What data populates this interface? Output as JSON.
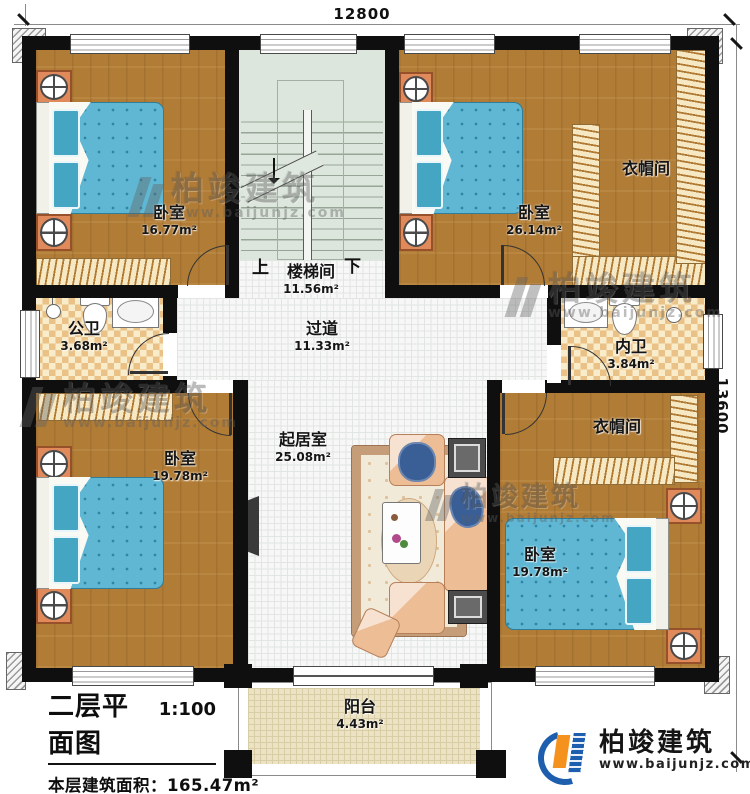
{
  "dimensions": {
    "top": "12800",
    "right": "13600"
  },
  "rooms": {
    "bedroom_tl": {
      "name": "卧室",
      "area": "16.77m²"
    },
    "bedroom_tr": {
      "name": "卧室",
      "area": "26.14m²"
    },
    "cloak_tr": {
      "name": "衣帽间"
    },
    "stair": {
      "name": "楼梯间",
      "area": "11.56m²",
      "up": "上",
      "down": "下"
    },
    "public_bath": {
      "name": "公卫",
      "area": "3.68m²"
    },
    "private_bath": {
      "name": "内卫",
      "area": "3.84m²"
    },
    "hall": {
      "name": "过道",
      "area": "11.33m²"
    },
    "living": {
      "name": "起居室",
      "area": "25.08m²"
    },
    "bedroom_bl": {
      "name": "卧室",
      "area": "19.78m²"
    },
    "bedroom_br": {
      "name": "卧室",
      "area": "19.78m²"
    },
    "cloak_br": {
      "name": "衣帽间"
    },
    "balcony": {
      "name": "阳台",
      "area": "4.43m²"
    }
  },
  "title_block": {
    "title": "二层平面图",
    "scale": "1:100",
    "area_line": "本层建筑面积：165.47m²",
    "height_line": "层高：3.1m"
  },
  "brand": {
    "name": "柏竣建筑",
    "url": "www.baijunjz.com"
  },
  "watermark": {
    "name": "柏竣建筑",
    "url": "www.baijunjz.com"
  },
  "colors": {
    "wall": "#0f0f0f",
    "wood_floor": "#b17c36",
    "bed_blue": "#5fb7d4",
    "nightstand_orange": "#e08a5c",
    "closet_tan": "#f7e8c4",
    "bath_tile": "#eac287",
    "stair_green": "#dde6dd",
    "balcony_tan": "#ece3c5",
    "brand_blue": "#1d5fae",
    "brand_orange": "#f5921e"
  }
}
